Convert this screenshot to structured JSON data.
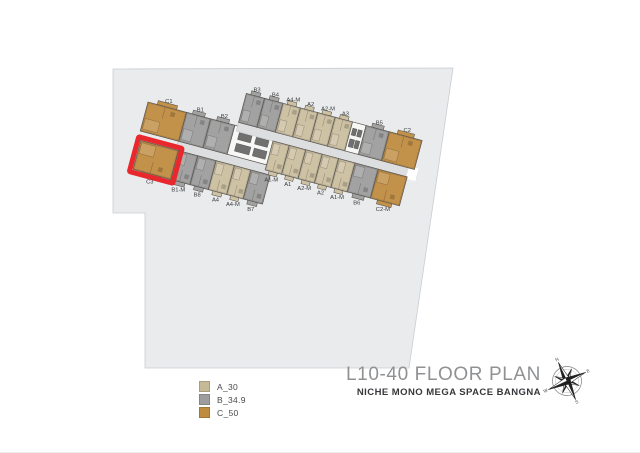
{
  "titleblock": {
    "title": "L10-40 FLOOR PLAN",
    "subtitle": "NICHE MONO MEGA SPACE BANGNA"
  },
  "legend": {
    "items": [
      {
        "label": "A_30",
        "color": "#c6b996"
      },
      {
        "label": "B_34.9",
        "color": "#9d9d9d"
      },
      {
        "label": "C_50",
        "color": "#bf8c3e"
      }
    ]
  },
  "selected_unit": "C3",
  "plan": {
    "site": {
      "fill": "#e9ebed",
      "stroke": "#c9ced2",
      "points": [
        [
          113,
          69
        ],
        [
          453,
          68
        ],
        [
          409,
          368
        ],
        [
          145,
          368
        ],
        [
          145,
          213
        ],
        [
          113,
          213
        ]
      ]
    },
    "colors": {
      "A": "#cec2a5",
      "B": "#a2a2a2",
      "C": "#c2914a",
      "core": "#f7f7f6",
      "corridor": "#dcdee0",
      "corridor_stroke": "#bfc2c4",
      "outline": "#57534d",
      "detail": "rgba(45,38,25,0.32)",
      "elevator": "#707070",
      "label": "#3a3a3a",
      "highlight": "#e8282c"
    },
    "row_height": 30,
    "corridor_height": 9,
    "wings": [
      {
        "name": "west-wing",
        "anchor": [
          148,
          102
        ],
        "angle": 15,
        "corridor": {
          "start": 39,
          "end": 137
        },
        "rows": [
          {
            "side": "top",
            "v": 0,
            "start": 0,
            "units": [
              {
                "label": "C1",
                "type": "C",
                "w": 40
              },
              {
                "label": "B1",
                "type": "B",
                "w": 25
              },
              {
                "label": "B2",
                "type": "B",
                "w": 25
              },
              {
                "label": "",
                "type": "core",
                "w": 44
              }
            ]
          },
          {
            "side": "bottom",
            "v": 39,
            "start": 3,
            "units": [
              {
                "label": "C3",
                "type": "C",
                "w": 39,
                "highlight": true
              },
              {
                "label": "B1-M",
                "type": "B",
                "w": 20
              },
              {
                "label": "B8",
                "type": "B",
                "w": 19
              },
              {
                "label": "A4",
                "type": "A",
                "w": 19
              },
              {
                "label": "A4-M",
                "type": "A",
                "w": 17
              },
              {
                "label": "B7",
                "type": "B",
                "w": 20
              }
            ]
          }
        ]
      },
      {
        "name": "east-wing",
        "anchor": [
          256,
          96
        ],
        "angle": 15,
        "corridor": {
          "start": -10,
          "end": 176
        },
        "corridor_end_gap": [
          166,
          176
        ],
        "rows": [
          {
            "side": "top",
            "v": 0,
            "start": -10,
            "units": [
              {
                "label": "B3",
                "type": "B",
                "w": 19
              },
              {
                "label": "B4",
                "type": "B",
                "w": 19
              },
              {
                "label": "A4-M",
                "type": "A",
                "w": 18
              },
              {
                "label": "A2",
                "type": "A",
                "w": 18
              },
              {
                "label": "A2-M",
                "type": "A",
                "w": 18
              },
              {
                "label": "A3",
                "type": "A",
                "w": 18
              },
              {
                "label": "",
                "type": "core",
                "w": 14
              },
              {
                "label": "B5",
                "type": "B",
                "w": 24
              },
              {
                "label": "C2",
                "type": "C",
                "w": 34
              }
            ]
          },
          {
            "side": "bottom",
            "v": 39,
            "start": 28,
            "units": [
              {
                "label": "A1-M",
                "type": "A",
                "w": 17
              },
              {
                "label": "A1",
                "type": "A",
                "w": 17
              },
              {
                "label": "A2-M",
                "type": "A",
                "w": 17
              },
              {
                "label": "A2",
                "type": "A",
                "w": 17
              },
              {
                "label": "A1-M",
                "type": "A",
                "w": 17
              },
              {
                "label": "B6",
                "type": "B",
                "w": 24
              },
              {
                "label": "C2-M",
                "type": "C",
                "w": 30
              }
            ]
          }
        ]
      }
    ]
  },
  "compass": {
    "letters": [
      "N",
      "E",
      "S",
      "W"
    ],
    "rotation": -25
  }
}
